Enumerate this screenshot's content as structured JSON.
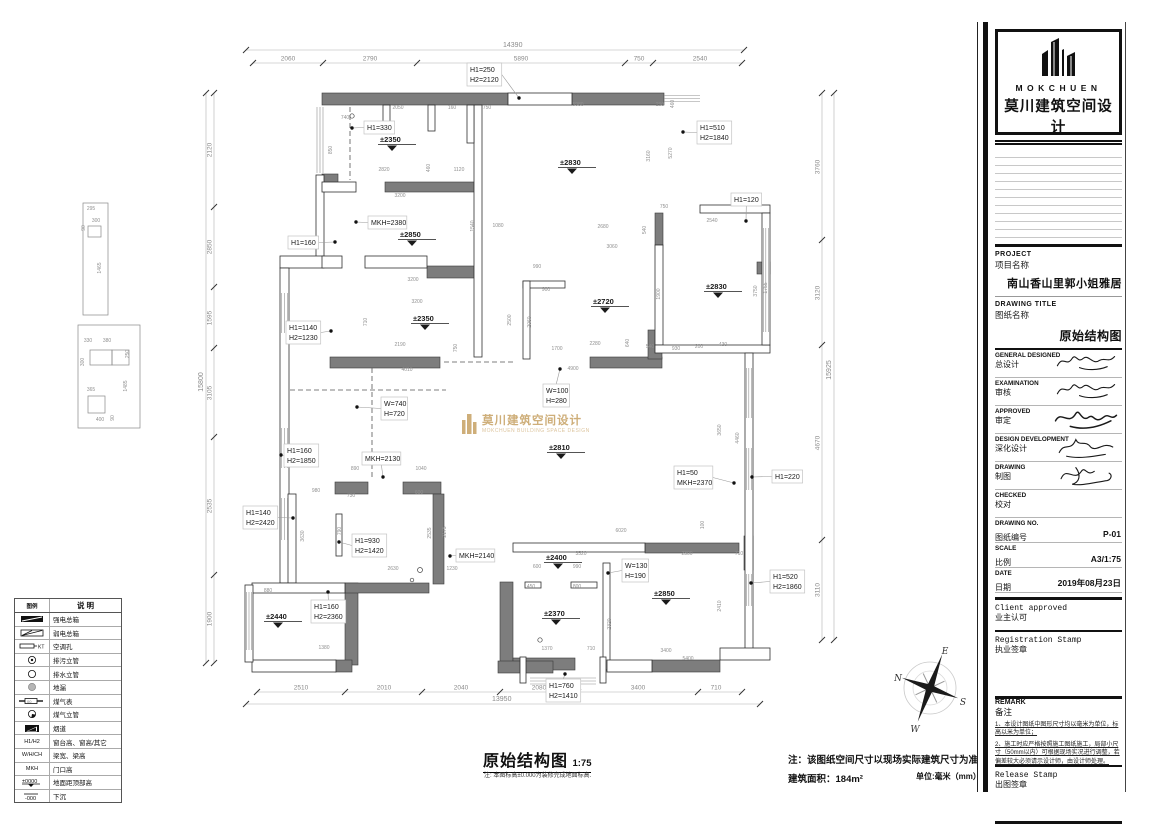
{
  "title_block": {
    "logo": {
      "brand": "MOKCHUEN",
      "brand_cn": "莫川建筑空间设计"
    },
    "project": {
      "en": "PROJECT",
      "cn": "项目名称",
      "value": "南山香山里郭小姐雅居"
    },
    "drawing_title": {
      "en": "DRAWING TITLE",
      "cn": "图纸名称",
      "value": "原始结构图"
    },
    "sign_rows": [
      {
        "en": "GENERAL  DESIGNED",
        "cn": "总设计",
        "signed": true
      },
      {
        "en": "EXAMINATION",
        "cn": "审核",
        "signed": true
      },
      {
        "en": "APPROVED",
        "cn": "审定",
        "signed": true
      },
      {
        "en": "DESIGN DEVELOPMENT",
        "cn": "深化设计",
        "signed": true
      },
      {
        "en": "DRAWING",
        "cn": "制图",
        "signed": true
      },
      {
        "en": "CHECKED",
        "cn": "校对",
        "signed": false
      }
    ],
    "info_rows": [
      {
        "en": "DRAWING NO.",
        "cn": "图纸编号",
        "value": "P-01"
      },
      {
        "en": "SCALE",
        "cn": "比例",
        "value": "A3/1:75"
      },
      {
        "en": "DATE",
        "cn": "日期",
        "value": "2019年08月23日"
      }
    ],
    "client_stamp": {
      "en": "Client approved",
      "cn": "业主认可"
    },
    "registration_stamp": {
      "en": "Registration Stamp",
      "cn": "执业签章"
    },
    "remark": {
      "en": "REMARK",
      "cn": "备注",
      "notes": [
        "1、本设计图纸中图形尺寸均以毫米为单位，标高以米为单位；",
        "2、施工时应严格按照施工图纸施工，局部小尺寸（50mm以内）可根据现场实况进行调整，若偏差较大必须请示设计师，由设计师处理。"
      ]
    },
    "release_stamp": {
      "en": "Release Stamp",
      "cn": "出图签章"
    }
  },
  "legend": {
    "headers": [
      "图例",
      "说 明"
    ],
    "rows": [
      {
        "icon": "strong-power-box",
        "sym": "",
        "label": "强电总箱"
      },
      {
        "icon": "weak-power-box",
        "sym": "",
        "label": "弱电总箱"
      },
      {
        "icon": "ac-hole",
        "sym": "KT",
        "label": "空调孔"
      },
      {
        "icon": "sewage-riser",
        "sym": "",
        "label": "排污立管"
      },
      {
        "icon": "drain-riser",
        "sym": "",
        "label": "排水立管"
      },
      {
        "icon": "floor-drain",
        "sym": "",
        "label": "地漏"
      },
      {
        "icon": "gas-meter",
        "sym": "",
        "label": "煤气表"
      },
      {
        "icon": "gas-riser",
        "sym": "",
        "label": "煤气立管"
      },
      {
        "icon": "flue",
        "sym": "",
        "label": "烟道"
      },
      {
        "icon": "text",
        "sym": "H1/H2",
        "label": "窗台高、窗高/其它"
      },
      {
        "icon": "text",
        "sym": "W/H/CH",
        "label": "梁宽、梁高"
      },
      {
        "icon": "text",
        "sym": "MKH",
        "label": "门口高"
      },
      {
        "icon": "elev",
        "sym": "±0000",
        "label": "地面距顶部高"
      },
      {
        "icon": "sink",
        "sym": "-000",
        "label": "下沉"
      }
    ]
  },
  "footer": {
    "title": "原始结构图",
    "scale": "1:75",
    "note": "注: 本图标高±0.000为装修完成地面标高.",
    "site_note": "注：该图纸空间尺寸以现场实际建筑尺寸为准。",
    "area": "建筑面积：184m²",
    "unit": "单位:毫米（mm）"
  },
  "watermark": {
    "cn": "莫川建筑空间设计",
    "en": "MOKCHUEN BUILDING SPACE DESIGN",
    "color": "#c9a66b"
  },
  "compass": {
    "n": "N",
    "e": "E",
    "s": "S",
    "w": "W"
  },
  "plan": {
    "chains": {
      "top_total": {
        "text": "14390",
        "x1": 246,
        "x2": 744,
        "y": 50,
        "lx": 503,
        "ly": 47
      },
      "top": {
        "y": 63,
        "ticks": [
          253,
          323,
          417,
          625,
          653,
          742
        ],
        "labels": [
          [
            "2060",
            288
          ],
          [
            "2790",
            370
          ],
          [
            "5890",
            521
          ],
          [
            "750",
            639
          ],
          [
            "2540",
            700
          ]
        ]
      },
      "bottom": {
        "y": 692,
        "ticks": [
          257,
          345,
          422,
          500,
          578,
          698,
          742
        ],
        "labels": [
          [
            "2510",
            301
          ],
          [
            "2010",
            384
          ],
          [
            "2040",
            461
          ],
          [
            "2080",
            539
          ],
          [
            "3400",
            638
          ],
          [
            "710",
            716
          ]
        ]
      },
      "bottom_total": {
        "text": "13950",
        "x1": 246,
        "x2": 760,
        "y": 704,
        "lx": 492,
        "ly": 701
      },
      "left": {
        "x": 214,
        "ticks": [
          93,
          207,
          287,
          348,
          437,
          575,
          663
        ],
        "labels": [
          [
            "2120",
            150
          ],
          [
            "2850",
            247
          ],
          [
            "1595",
            318
          ],
          [
            "3105",
            393
          ],
          [
            "2535",
            506
          ],
          [
            "1900",
            619
          ]
        ]
      },
      "left_total": {
        "text": "15800",
        "x": 206,
        "y1": 93,
        "y2": 663,
        "lx": 203,
        "ly": 382
      },
      "right": {
        "x": 822,
        "ticks": [
          93,
          240,
          345,
          540,
          640
        ],
        "labels": [
          [
            "3760",
            167
          ],
          [
            "3120",
            293
          ],
          [
            "4670",
            443
          ],
          [
            "3110",
            590
          ]
        ]
      },
      "right_total": {
        "text": "15925",
        "x": 834,
        "y1": 93,
        "y2": 640,
        "lx": 831,
        "ly": 370
      }
    },
    "labels": [
      {
        "lines": [
          "H1=250",
          "H2=2120"
        ],
        "x": 467,
        "y": 63,
        "ax": 519,
        "ay": 98
      },
      {
        "lines": [
          "H1=330"
        ],
        "x": 364,
        "y": 121,
        "ax": 352,
        "ay": 128
      },
      {
        "lines": [
          "H1=510",
          "H2=1840"
        ],
        "x": 697,
        "y": 121,
        "ax": 683,
        "ay": 132
      },
      {
        "lines": [
          "H1=120"
        ],
        "x": 731,
        "y": 193,
        "ax": 746,
        "ay": 221
      },
      {
        "lines": [
          "MKH=2380"
        ],
        "x": 368,
        "y": 216,
        "ax": 356,
        "ay": 222
      },
      {
        "lines": [
          "H1=160"
        ],
        "x": 288,
        "y": 236,
        "ax": 335,
        "ay": 242
      },
      {
        "lines": [
          "H1=1140",
          "H2=1230"
        ],
        "x": 286,
        "y": 321,
        "ax": 331,
        "ay": 331
      },
      {
        "lines": [
          "W=100",
          "H=280"
        ],
        "x": 543,
        "y": 384,
        "ax": 560,
        "ay": 369
      },
      {
        "lines": [
          "W=740",
          "H=720"
        ],
        "x": 381,
        "y": 397,
        "ax": 357,
        "ay": 407
      },
      {
        "lines": [
          "H1=160",
          "H2=1850"
        ],
        "x": 284,
        "y": 444,
        "ax": 281,
        "ay": 455
      },
      {
        "lines": [
          "MKH=2130"
        ],
        "x": 362,
        "y": 452,
        "ax": 383,
        "ay": 477
      },
      {
        "lines": [
          "H1=50",
          "MKH=2370"
        ],
        "x": 674,
        "y": 466,
        "ax": 734,
        "ay": 483
      },
      {
        "lines": [
          "H1=220"
        ],
        "x": 772,
        "y": 470,
        "ax": 752,
        "ay": 477
      },
      {
        "lines": [
          "H1=140",
          "H2=2420"
        ],
        "x": 243,
        "y": 506,
        "ax": 293,
        "ay": 518
      },
      {
        "lines": [
          "H1=930",
          "H2=1420"
        ],
        "x": 352,
        "y": 534,
        "ax": 339,
        "ay": 542
      },
      {
        "lines": [
          "MKH=2140"
        ],
        "x": 456,
        "y": 549,
        "ax": 450,
        "ay": 556
      },
      {
        "lines": [
          "W=130",
          "H=190"
        ],
        "x": 622,
        "y": 559,
        "ax": 608,
        "ay": 573
      },
      {
        "lines": [
          "H1=520",
          "H2=1860"
        ],
        "x": 770,
        "y": 570,
        "ax": 751,
        "ay": 583
      },
      {
        "lines": [
          "H1=160",
          "H2=2360"
        ],
        "x": 311,
        "y": 600,
        "ax": 328,
        "ay": 592
      },
      {
        "lines": [
          "H1=760",
          "H2=1410"
        ],
        "x": 546,
        "y": 679,
        "ax": 565,
        "ay": 674
      }
    ],
    "elevations": [
      {
        "v": "±2350",
        "x": 380,
        "y": 142
      },
      {
        "v": "±2850",
        "x": 400,
        "y": 237
      },
      {
        "v": "±2830",
        "x": 560,
        "y": 165
      },
      {
        "v": "±2830",
        "x": 706,
        "y": 289
      },
      {
        "v": "±2350",
        "x": 413,
        "y": 321
      },
      {
        "v": "±2720",
        "x": 593,
        "y": 304
      },
      {
        "v": "±2810",
        "x": 549,
        "y": 450
      },
      {
        "v": "±2400",
        "x": 546,
        "y": 560
      },
      {
        "v": "±2370",
        "x": 544,
        "y": 616
      },
      {
        "v": "±2440",
        "x": 266,
        "y": 619
      },
      {
        "v": "±2850",
        "x": 654,
        "y": 596
      }
    ],
    "small_dims": [
      {
        "t": "2050",
        "x": 398,
        "y": 109
      },
      {
        "t": "160",
        "x": 452,
        "y": 109
      },
      {
        "t": "750",
        "x": 487,
        "y": 109
      },
      {
        "t": "740",
        "x": 345,
        "y": 119
      },
      {
        "t": "850",
        "x": 332,
        "y": 150,
        "r": 1
      },
      {
        "t": "2820",
        "x": 384,
        "y": 171
      },
      {
        "t": "460",
        "x": 430,
        "y": 168,
        "r": 1
      },
      {
        "t": "1120",
        "x": 459,
        "y": 171
      },
      {
        "t": "3200",
        "x": 400,
        "y": 197
      },
      {
        "t": "1540",
        "x": 474,
        "y": 226,
        "r": 1
      },
      {
        "t": "1080",
        "x": 498,
        "y": 227
      },
      {
        "t": "3200",
        "x": 413,
        "y": 281
      },
      {
        "t": "5980",
        "x": 578,
        "y": 106
      },
      {
        "t": "290",
        "x": 660,
        "y": 106
      },
      {
        "t": "460",
        "x": 674,
        "y": 104,
        "r": 1
      },
      {
        "t": "3160",
        "x": 650,
        "y": 156,
        "r": 1
      },
      {
        "t": "5270",
        "x": 672,
        "y": 153,
        "r": 1
      },
      {
        "t": "750",
        "x": 664,
        "y": 208
      },
      {
        "t": "2680",
        "x": 603,
        "y": 228
      },
      {
        "t": "540",
        "x": 646,
        "y": 230,
        "r": 1
      },
      {
        "t": "3060",
        "x": 612,
        "y": 248
      },
      {
        "t": "990",
        "x": 537,
        "y": 268
      },
      {
        "t": "2540",
        "x": 712,
        "y": 222
      },
      {
        "t": "900",
        "x": 546,
        "y": 291
      },
      {
        "t": "1900",
        "x": 660,
        "y": 294,
        "r": 1
      },
      {
        "t": "3750",
        "x": 757,
        "y": 291,
        "r": 1
      },
      {
        "t": "2500",
        "x": 511,
        "y": 320,
        "r": 1
      },
      {
        "t": "2060",
        "x": 531,
        "y": 322,
        "r": 1
      },
      {
        "t": "1700",
        "x": 557,
        "y": 350
      },
      {
        "t": "2280",
        "x": 595,
        "y": 345
      },
      {
        "t": "640",
        "x": 629,
        "y": 343,
        "r": 1
      },
      {
        "t": "540",
        "x": 650,
        "y": 348
      },
      {
        "t": "930",
        "x": 676,
        "y": 350
      },
      {
        "t": "200",
        "x": 699,
        "y": 348
      },
      {
        "t": "430",
        "x": 723,
        "y": 346
      },
      {
        "t": "4900",
        "x": 573,
        "y": 370
      },
      {
        "t": "3650",
        "x": 721,
        "y": 430,
        "r": 1
      },
      {
        "t": "4460",
        "x": 739,
        "y": 438,
        "r": 1
      },
      {
        "t": "3200",
        "x": 417,
        "y": 303
      },
      {
        "t": "710",
        "x": 367,
        "y": 322,
        "r": 1
      },
      {
        "t": "2190",
        "x": 400,
        "y": 346
      },
      {
        "t": "750",
        "x": 457,
        "y": 348,
        "r": 1
      },
      {
        "t": "4010",
        "x": 407,
        "y": 371
      },
      {
        "t": "890",
        "x": 355,
        "y": 470
      },
      {
        "t": "1040",
        "x": 421,
        "y": 470
      },
      {
        "t": "980",
        "x": 316,
        "y": 492
      },
      {
        "t": "730",
        "x": 351,
        "y": 497
      },
      {
        "t": "600",
        "x": 419,
        "y": 494
      },
      {
        "t": "790",
        "x": 341,
        "y": 531,
        "r": 1
      },
      {
        "t": "2630",
        "x": 393,
        "y": 570
      },
      {
        "t": "2535",
        "x": 431,
        "y": 533,
        "r": 1
      },
      {
        "t": "2175",
        "x": 446,
        "y": 532,
        "r": 1
      },
      {
        "t": "1230",
        "x": 452,
        "y": 570
      },
      {
        "t": "880",
        "x": 268,
        "y": 592
      },
      {
        "t": "1380",
        "x": 324,
        "y": 649
      },
      {
        "t": "3630",
        "x": 304,
        "y": 536,
        "r": 1
      },
      {
        "t": "6020",
        "x": 621,
        "y": 532
      },
      {
        "t": "3520",
        "x": 581,
        "y": 555
      },
      {
        "t": "2300",
        "x": 687,
        "y": 555
      },
      {
        "t": "710",
        "x": 739,
        "y": 555
      },
      {
        "t": "600",
        "x": 537,
        "y": 568
      },
      {
        "t": "990",
        "x": 577,
        "y": 568
      },
      {
        "t": "450",
        "x": 531,
        "y": 588
      },
      {
        "t": "800",
        "x": 577,
        "y": 588
      },
      {
        "t": "1370",
        "x": 547,
        "y": 650
      },
      {
        "t": "710",
        "x": 591,
        "y": 650
      },
      {
        "t": "3400",
        "x": 666,
        "y": 652
      },
      {
        "t": "5400",
        "x": 688,
        "y": 660
      },
      {
        "t": "2410",
        "x": 721,
        "y": 606,
        "r": 1
      },
      {
        "t": "2320",
        "x": 611,
        "y": 624,
        "r": 1
      },
      {
        "t": "1755",
        "x": 767,
        "y": 288,
        "r": 1
      },
      {
        "t": "100",
        "x": 704,
        "y": 525,
        "r": 1
      },
      {
        "t": "295",
        "x": 91,
        "y": 210
      },
      {
        "t": "90",
        "x": 85,
        "y": 228,
        "r": 1
      },
      {
        "t": "300",
        "x": 96,
        "y": 222
      },
      {
        "t": "1465",
        "x": 101,
        "y": 268,
        "r": 1
      },
      {
        "t": "330",
        "x": 88,
        "y": 342
      },
      {
        "t": "380",
        "x": 107,
        "y": 342
      },
      {
        "t": "250",
        "x": 129,
        "y": 354,
        "r": 1
      },
      {
        "t": "300",
        "x": 84,
        "y": 362,
        "r": 1
      },
      {
        "t": "365",
        "x": 91,
        "y": 391
      },
      {
        "t": "1485",
        "x": 127,
        "y": 386,
        "r": 1
      },
      {
        "t": "400",
        "x": 100,
        "y": 421
      },
      {
        "t": "90",
        "x": 114,
        "y": 418,
        "r": 1
      }
    ]
  }
}
